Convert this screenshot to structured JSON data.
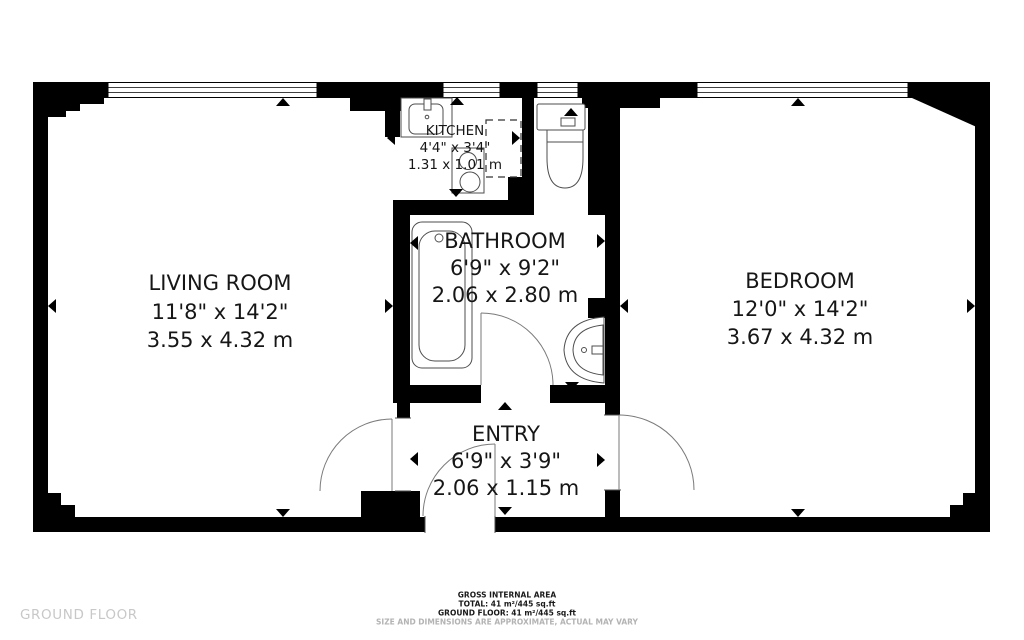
{
  "floor_label": "GROUND FLOOR",
  "rooms": {
    "living_room": {
      "name": "LIVING ROOM",
      "imperial": "11'8\" x 14'2\"",
      "metric": "3.55 x 4.32 m"
    },
    "kitchen": {
      "name": "KITCHEN",
      "imperial": "4'4\" x 3'4\"",
      "metric": "1.31 x 1.01 m"
    },
    "bathroom": {
      "name": "BATHROOM",
      "imperial": "6'9\" x 9'2\"",
      "metric": "2.06 x 2.80 m"
    },
    "bedroom": {
      "name": "BEDROOM",
      "imperial": "12'0\" x 14'2\"",
      "metric": "3.67 x 4.32 m"
    },
    "entry": {
      "name": "ENTRY",
      "imperial": "6'9\" x 3'9\"",
      "metric": "2.06 x 1.15 m"
    }
  },
  "footer": {
    "area_heading": "GROSS INTERNAL AREA",
    "total": "TOTAL: 41 m²/445 sq.ft",
    "ground_floor": "GROUND FLOOR: 41 m²/445 sq.ft",
    "disclaimer": "SIZE AND DIMENSIONS ARE APPROXIMATE, ACTUAL MAY VARY"
  },
  "colors": {
    "wall": "#000000",
    "fixture_stroke": "#4d4d4d",
    "door_stroke": "#7a7a7a",
    "floor_label_text": "#c8c8c8",
    "footer_text": "#1a1a1a",
    "footer_muted_text": "#b3b3b3"
  }
}
